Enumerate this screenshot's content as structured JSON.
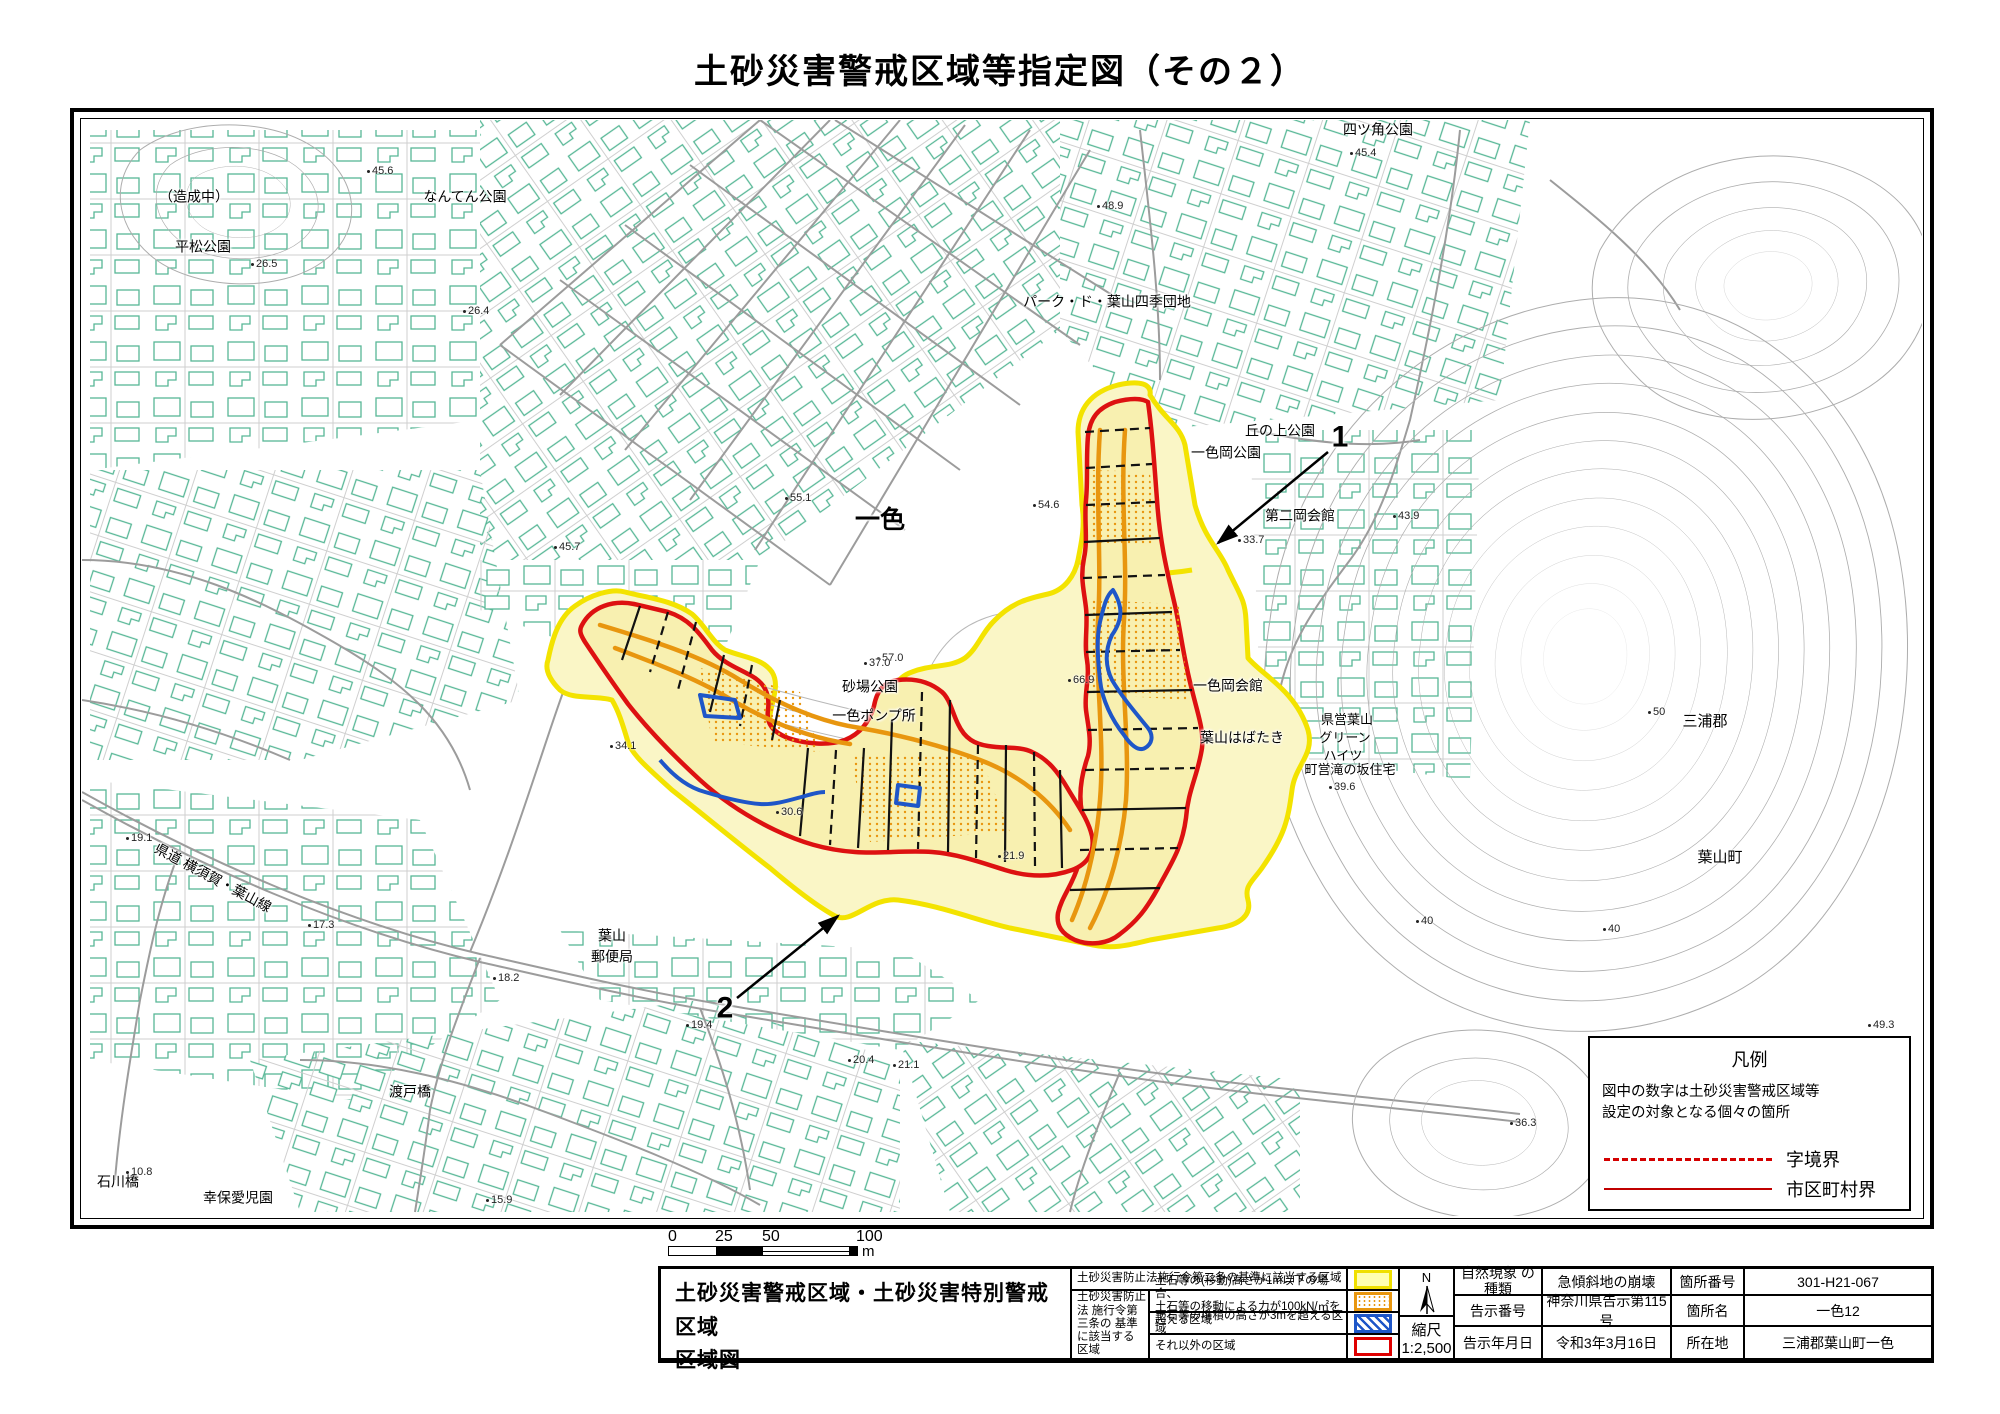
{
  "title": "土砂災害警戒区域等指定図（その２）",
  "colors": {
    "warning_zone_border": "#F3E300",
    "warning_zone_fill": "#FAF6C6",
    "special_zone_border": "#DD1111",
    "debris_move_orange": "#E8960F",
    "debris_pile_blue": "#1E56C8",
    "building_outline": "#57B796",
    "contour_gray": "#ADADAD",
    "boundary_red": "#CC0000"
  },
  "map": {
    "labels": [
      {
        "t": "（造成中）",
        "x": 194,
        "y": 197,
        "s": 14
      },
      {
        "t": "平松公園",
        "x": 203,
        "y": 247,
        "s": 14
      },
      {
        "t": "なんてん公園",
        "x": 465,
        "y": 197,
        "s": 14
      },
      {
        "t": "四ツ角公園",
        "x": 1378,
        "y": 130,
        "s": 14
      },
      {
        "t": "パーク・ド・葉山四季団地",
        "x": 1107,
        "y": 302,
        "s": 14
      },
      {
        "t": "一色",
        "x": 880,
        "y": 520,
        "s": 25,
        "b": 1
      },
      {
        "t": "丘の上公園",
        "x": 1280,
        "y": 431,
        "s": 14
      },
      {
        "t": "一色岡公園",
        "x": 1226,
        "y": 453,
        "s": 14
      },
      {
        "t": "第二岡会館",
        "x": 1300,
        "y": 516,
        "s": 14
      },
      {
        "t": "一色岡会館",
        "x": 1228,
        "y": 686,
        "s": 14
      },
      {
        "t": "葉山はばたき",
        "x": 1242,
        "y": 738,
        "s": 14
      },
      {
        "t": "県営葉山",
        "x": 1347,
        "y": 720,
        "s": 13
      },
      {
        "t": "グリーン",
        "x": 1345,
        "y": 738,
        "s": 13
      },
      {
        "t": "ハイツ",
        "x": 1343,
        "y": 756,
        "s": 13
      },
      {
        "t": "町営滝の坂住宅",
        "x": 1350,
        "y": 770,
        "s": 13
      },
      {
        "t": "三浦郡",
        "x": 1705,
        "y": 722,
        "s": 15
      },
      {
        "t": "葉山町",
        "x": 1720,
        "y": 858,
        "s": 15
      },
      {
        "t": "砂場公園",
        "x": 870,
        "y": 687,
        "s": 14
      },
      {
        "t": "一色ポンプ所",
        "x": 874,
        "y": 716,
        "s": 14
      },
      {
        "t": "葉山",
        "x": 612,
        "y": 936,
        "s": 14
      },
      {
        "t": "郵便局",
        "x": 612,
        "y": 957,
        "s": 14
      },
      {
        "t": "渡戸橋",
        "x": 410,
        "y": 1092,
        "s": 14
      },
      {
        "t": "石川橋",
        "x": 118,
        "y": 1182,
        "s": 14
      },
      {
        "t": "幸保愛児園",
        "x": 238,
        "y": 1198,
        "s": 14
      },
      {
        "t": "県道 横須賀・葉山線",
        "x": 213,
        "y": 878,
        "s": 14,
        "r": 28
      },
      {
        "t": "1",
        "x": 1340,
        "y": 437,
        "s": 30,
        "b": 1
      },
      {
        "t": "2",
        "x": 725,
        "y": 1008,
        "s": 30,
        "b": 1
      }
    ],
    "spot_elevations": [
      {
        "v": "45.6",
        "x": 369,
        "y": 171
      },
      {
        "v": "26.5",
        "x": 253,
        "y": 264
      },
      {
        "v": "26.4",
        "x": 465,
        "y": 311
      },
      {
        "v": "48.9",
        "x": 1099,
        "y": 206
      },
      {
        "v": "45.4",
        "x": 1352,
        "y": 153
      },
      {
        "v": "54.6",
        "x": 1035,
        "y": 505
      },
      {
        "v": "55.1",
        "x": 787,
        "y": 498
      },
      {
        "v": "45.7",
        "x": 556,
        "y": 547
      },
      {
        "v": "33.7",
        "x": 1240,
        "y": 540
      },
      {
        "v": "43.9",
        "x": 1395,
        "y": 516
      },
      {
        "v": "57.0",
        "x": 879,
        "y": 658
      },
      {
        "v": "37.0",
        "x": 866,
        "y": 663
      },
      {
        "v": "66.9",
        "x": 1070,
        "y": 680
      },
      {
        "v": "34.1",
        "x": 612,
        "y": 746
      },
      {
        "v": "30.6",
        "x": 778,
        "y": 812
      },
      {
        "v": "21.9",
        "x": 1000,
        "y": 856
      },
      {
        "v": "19.1",
        "x": 128,
        "y": 838
      },
      {
        "v": "17.3",
        "x": 310,
        "y": 925
      },
      {
        "v": "18.2",
        "x": 495,
        "y": 978
      },
      {
        "v": "19.4",
        "x": 688,
        "y": 1025
      },
      {
        "v": "20.4",
        "x": 850,
        "y": 1060
      },
      {
        "v": "21.1",
        "x": 895,
        "y": 1065
      },
      {
        "v": "15.9",
        "x": 488,
        "y": 1200
      },
      {
        "v": "10.8",
        "x": 128,
        "y": 1172
      },
      {
        "v": "36.3",
        "x": 1512,
        "y": 1123
      },
      {
        "v": "49.3",
        "x": 1870,
        "y": 1025
      },
      {
        "v": "39.6",
        "x": 1331,
        "y": 787
      },
      {
        "v": "50",
        "x": 1650,
        "y": 712
      },
      {
        "v": "40",
        "x": 1418,
        "y": 921
      },
      {
        "v": "40",
        "x": 1605,
        "y": 929
      }
    ]
  },
  "legend_box": {
    "title": "凡例",
    "note_line1": "図中の数字は土砂災害警戒区域等",
    "note_line2": "設定の対象となる個々の箇所",
    "items": [
      {
        "label": "字境界",
        "style": "dashed-red"
      },
      {
        "label": "市区町村界",
        "style": "solid-red"
      }
    ]
  },
  "scalebar": {
    "ticks": [
      "0",
      "25",
      "50",
      "100"
    ],
    "unit": "m"
  },
  "table": {
    "map_title_line1": "土砂災害警戒区域・土砂災害特別警戒区域",
    "map_title_line2": "区域図",
    "law2_label": "土砂災害防止法施行令第二条の基準に該当する区域",
    "law3_lines": "土砂災害防止法 施行令第三条の 基準に該当する 区域",
    "row2_line1": "土石等の(移動)高さが1m以下の場合、",
    "row2_line2": "土石等の移動による力が100kN/㎡を超える区域",
    "row3_label": "土石等の堆積の高さが3mを超える区域",
    "row4_label": "それ以外の区域",
    "north_label": "N",
    "scale_label": "縮尺",
    "scale_value": "1:2,500",
    "info": {
      "h_phenomenon": "自然現象 の種類",
      "v_phenomenon": "急傾斜地の崩壊",
      "h_notice_no": "告示番号",
      "v_notice_no": "神奈川県告示第115号",
      "h_notice_date": "告示年月日",
      "v_notice_date": "令和3年3月16日",
      "h_site_no": "箇所番号",
      "v_site_no": "301-H21-067",
      "h_site_name": "箇所名",
      "v_site_name": "一色12",
      "h_location": "所在地",
      "v_location": "三浦郡葉山町一色"
    }
  }
}
